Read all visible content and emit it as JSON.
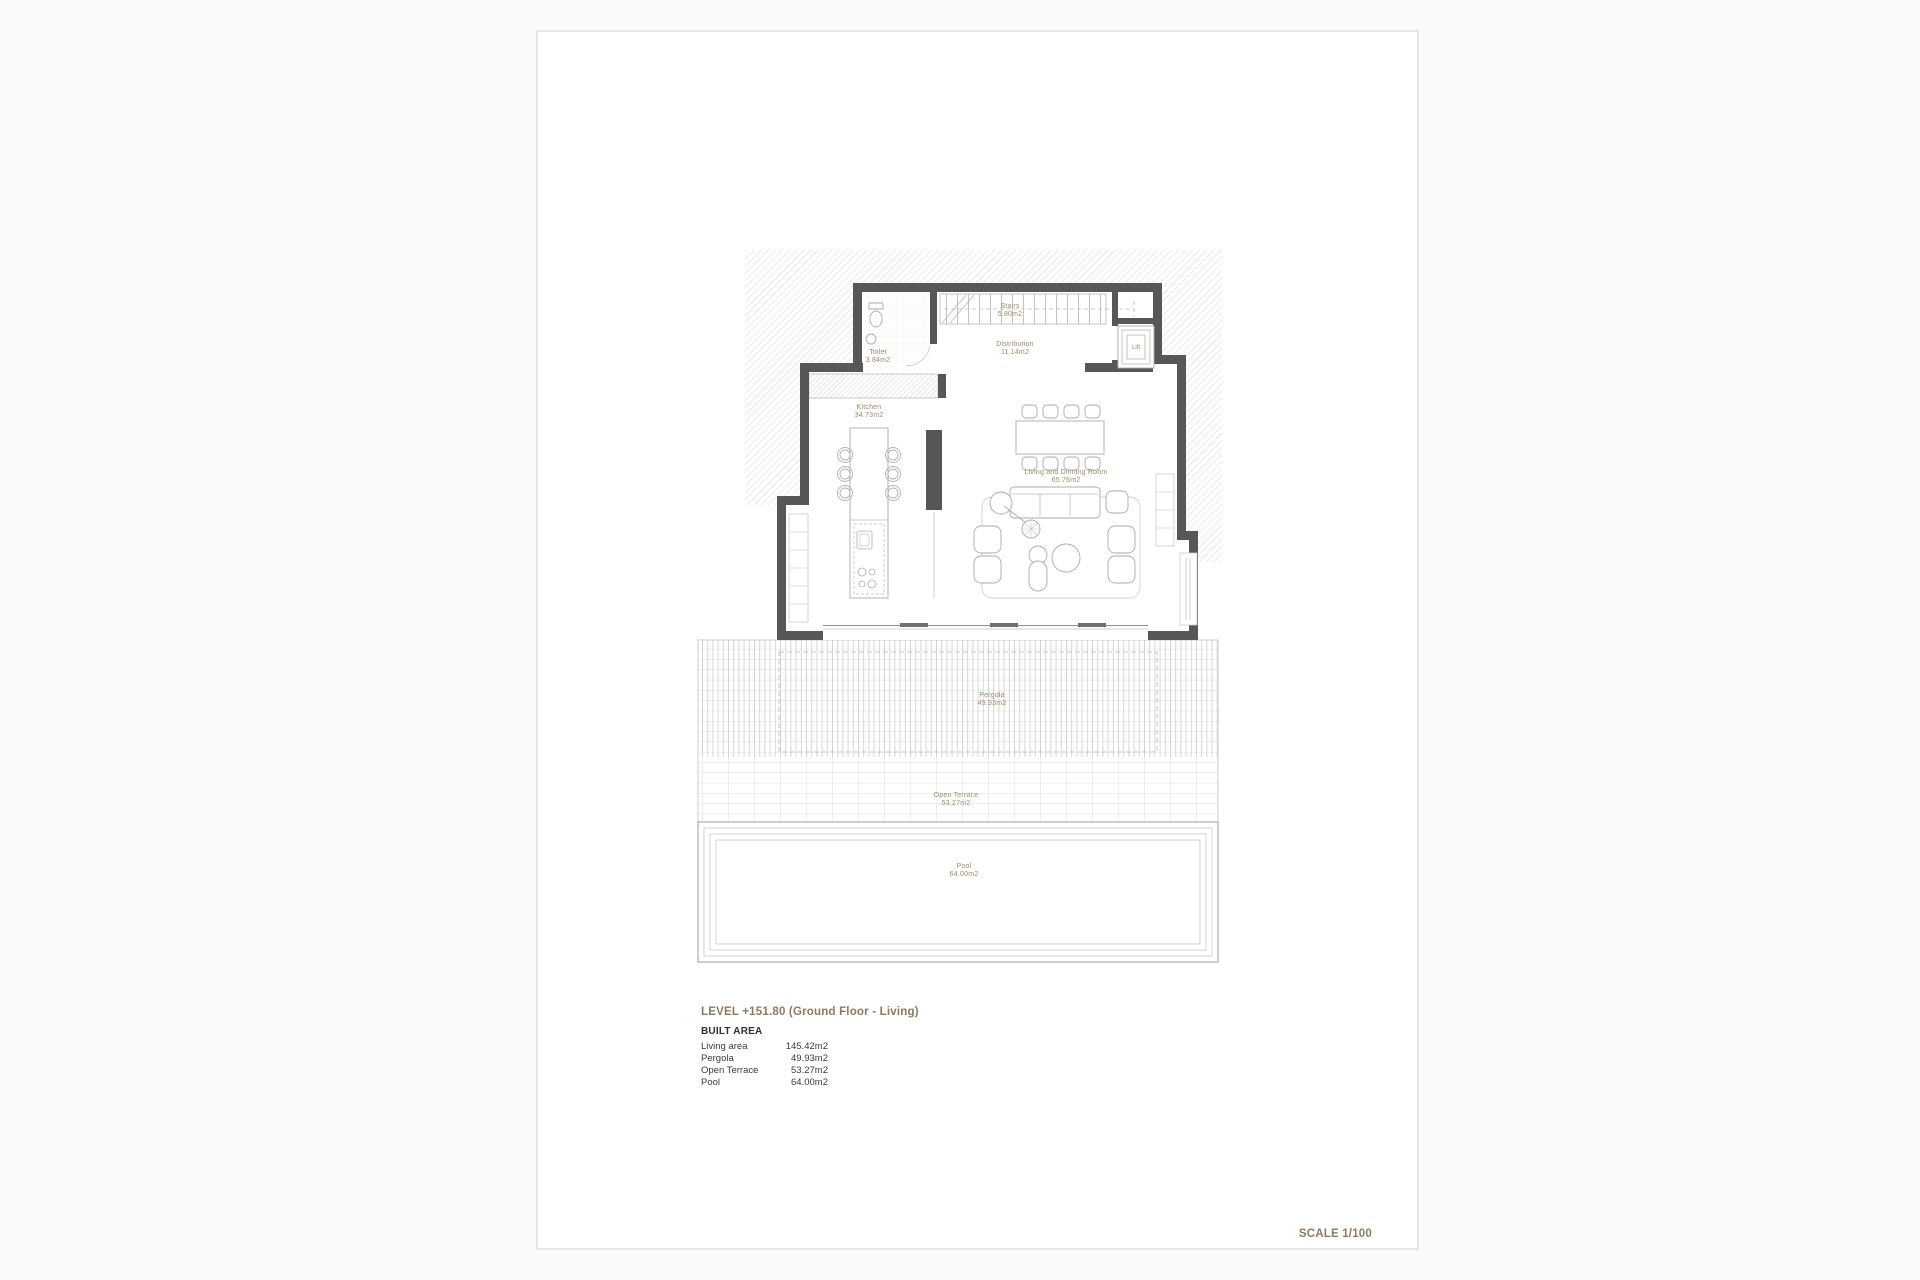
{
  "sheet": {
    "title": "LEVEL +151.80 (Ground Floor - Living)",
    "scale_label": "SCALE 1/100"
  },
  "rooms": {
    "toilet": {
      "name": "Toilet",
      "area": "3.84m2"
    },
    "stairs": {
      "name": "Stairs",
      "area": "5.80m2"
    },
    "distribution": {
      "name": "Distribution",
      "area": "11.14m2"
    },
    "lift": {
      "name": "Lift"
    },
    "kitchen": {
      "name": "Kitchen",
      "area": "34.73m2"
    },
    "living": {
      "name": "Living and Dinning Room",
      "area": "65.76m2"
    },
    "pergola": {
      "name": "Pergola",
      "area": "49.93m2"
    },
    "open_terrace": {
      "name": "Open Terrace",
      "area": "53.27m2"
    },
    "pool": {
      "name": "Pool",
      "area": "64.00m2"
    }
  },
  "built_area": {
    "heading": "BUILT AREA",
    "rows": [
      {
        "label": "Living area",
        "value": "145.42m2"
      },
      {
        "label": "Pergola",
        "value": "49.93m2"
      },
      {
        "label": "Open Terrace",
        "value": "53.27m2"
      },
      {
        "label": "Pool",
        "value": "64.00m2"
      }
    ]
  },
  "colors": {
    "wall": "#57575a",
    "room_label": "#a08a65",
    "heading": "#8c7a5f",
    "table_text": "#3a3a3a",
    "hatch_line": "#d4d4d4"
  }
}
